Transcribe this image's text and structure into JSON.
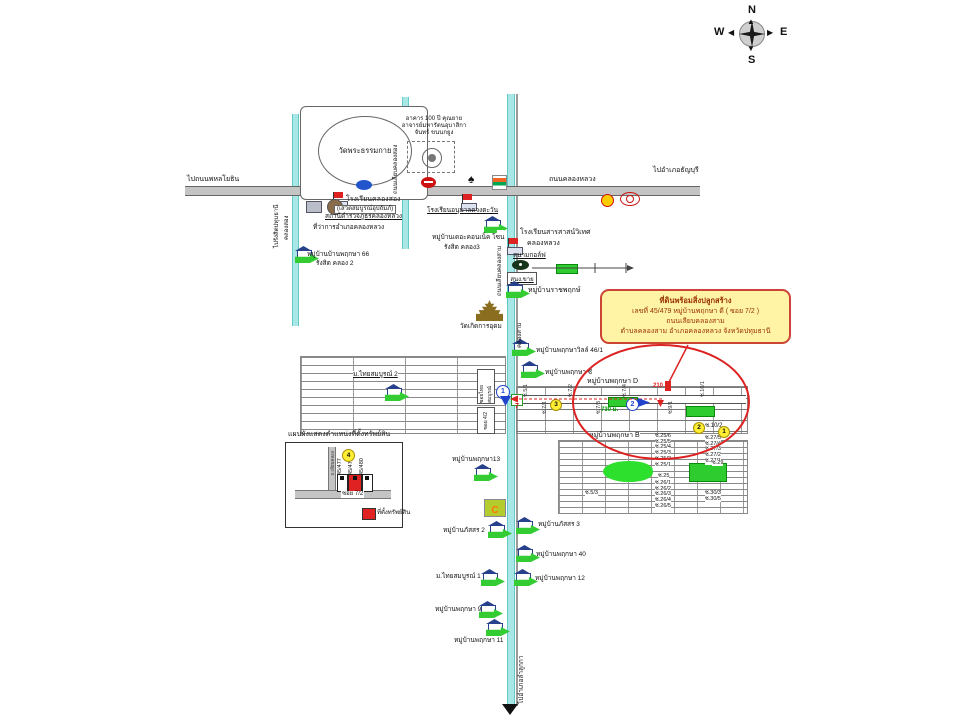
{
  "compass": {
    "north": "N",
    "south": "S",
    "east": "E",
    "west": "W"
  },
  "callout": {
    "line1": "ที่ดินพร้อมสิ่งปลูกสร้าง",
    "line2": "เลขที่ 45/479  หมู่บ้านพฤกษา ดี  ( ซอย 7/2 )",
    "line3": "ถนนเลียบคลองสาม",
    "line4": "ตำบลคลองสาม อำเภอคลองหลวง  จังหวัดปทุมธานี"
  },
  "roads": {
    "main_name": "ถนนคลองหลวง",
    "to_west": "ไปถนนพหลโยธิน",
    "to_east": "ไปอำเภอธัญบุรี",
    "to_south": "ไปอำเภอลำลูกกา",
    "canal2_name": "คลองสอง",
    "canal2_dir": "ไปรังสิตปทุมธานี",
    "canal2_road": "ถนนเลียบคลองสอง",
    "canal3_name": "คลองสาม",
    "canal3_road": "ถนนเลียบคลองสาม"
  },
  "temple_area": {
    "wat_dhammakaya": "วัดพระธรรมกาย",
    "building_100y": "อาคาร 100 ปี คุณยายอาจารย์มหารัตนอุบาสิกาจันทร์ ขนนกยูง"
  },
  "north_landmarks": {
    "school_klongsong": "โรงเรียนคลองสอง",
    "school_klongsong_sub": "(เสวตสมบูรณ์อุปถัมภ์)",
    "police": "สถานีตำรวจภูธรคลองหลวง",
    "district_office": "ที่ว่าการอำเภอคลองหลวง",
    "kindergarten": "โรงเรียนอนุบาลดวงตะวัน",
    "village66_line1": "หมู่บ้านบ้านพฤกษา 66",
    "village66_line2": "รังสิต คลอง 2"
  },
  "mid_landmarks": {
    "connect_line1": "หมู่บ้านเดอะคอนเน็ค โซน",
    "connect_line2": "รังสิต คลอง3",
    "sarasas_line1": "โรงเรียนสารสาสน์วิเทศ",
    "sarasas_line2": "คลองหลวง",
    "golf": "สนามกอล์ฟ",
    "sales_office": "สนง.ขาย",
    "ratchaphruek": "หมู่บ้านราชพฤกษ์",
    "wat_koed": "วัดเกิดการอุดม",
    "pruksa_ville": "หมู่บ้านพฤกษาวิลล์ 46/1",
    "pruksa_c": "หมู่บ้านพฤกษา ซี"
  },
  "thai_somboon": {
    "label": "ม.ไทยสมบูรณ์ 2",
    "soi_box1": "ซอยไทยสมบูรณ์",
    "soi_box2": "ซอย 4/2"
  },
  "grid_d": {
    "label": "หมู่บ้านพฤกษา D",
    "dist_210": "210 ม.",
    "dist_730": "730 ม.",
    "num1": "1",
    "num2": "2",
    "num3": "3",
    "num7": "7",
    "soi_102": "ซ.10/2",
    "yellow2": "2",
    "yellow1": "1",
    "ticks": [
      "ซ.5/1",
      "ซ.7/1",
      "ซ.7/2",
      "ซ.7/3",
      "ซ.7/4",
      "ซ.9/1",
      "ซ.10/1"
    ]
  },
  "grid_b": {
    "label": "หมู่บ้านพฤกษา B",
    "mid_a": [
      "ซ.25/6",
      "ซ.25/5",
      "ซ.25/4",
      "ซ.25/3",
      "ซ.25/2",
      "ซ.25/1"
    ],
    "mid_25": "ซ.25",
    "mid_b": [
      "ซ.26/1",
      "ซ.26/2",
      "ซ.26/3",
      "ซ.26/4",
      "ซ.26/5"
    ],
    "right_a": [
      "ซ.27/5",
      "ซ.27/4",
      "ซ.27/3",
      "ซ.27/2",
      "ซ.27/1"
    ],
    "right_29": "ซ.29",
    "right_b": [
      "ซ.30/3",
      "ซ.30/5"
    ],
    "soi_53": "ซ.5/3"
  },
  "legend": {
    "title": "แผนผังแสดงตำแหน่งที่ตั้งทรัพย์สิน",
    "num4": "4",
    "plots": [
      "45/477",
      "45/479",
      "45/480"
    ],
    "soi": "ซอย 7/2",
    "road_label": "ถ.เลียบคลอง",
    "key_label": "ที่ตั้งทรัพย์สิน"
  },
  "south_villages": {
    "p13": "หมู่บ้านพฤกษา13",
    "passorn2": "หมู่บ้านภัสสร 2",
    "passorn3": "หมู่บ้านภัสสร 3",
    "p40": "หมู่บ้านพฤกษา 40",
    "thaisomboon1": "ม.ไทยสมบูรณ์ 1",
    "p12": "หมู่บ้านพฤกษา 12",
    "p9": "หมู่บ้านพฤกษา 9",
    "p11": "หมู่บ้านพฤกษา 11"
  },
  "icons": {
    "spade_glyph": "♠",
    "store_logo_glyph": "C",
    "lotus": "blue-oval-store",
    "honda": "red-oval-dealer",
    "seven_eleven": "7-11-store",
    "shell": "shell-gas-station",
    "toyota": "toyota-dealer"
  },
  "colors": {
    "callout_bg": "#fff3a6",
    "callout_border": "#cc4433",
    "highlight_red": "#dd2222",
    "arrow_green": "#33cc33",
    "canal": "#a9e7e7",
    "distance_green": "#00a000",
    "distance_red": "#dd2222"
  }
}
